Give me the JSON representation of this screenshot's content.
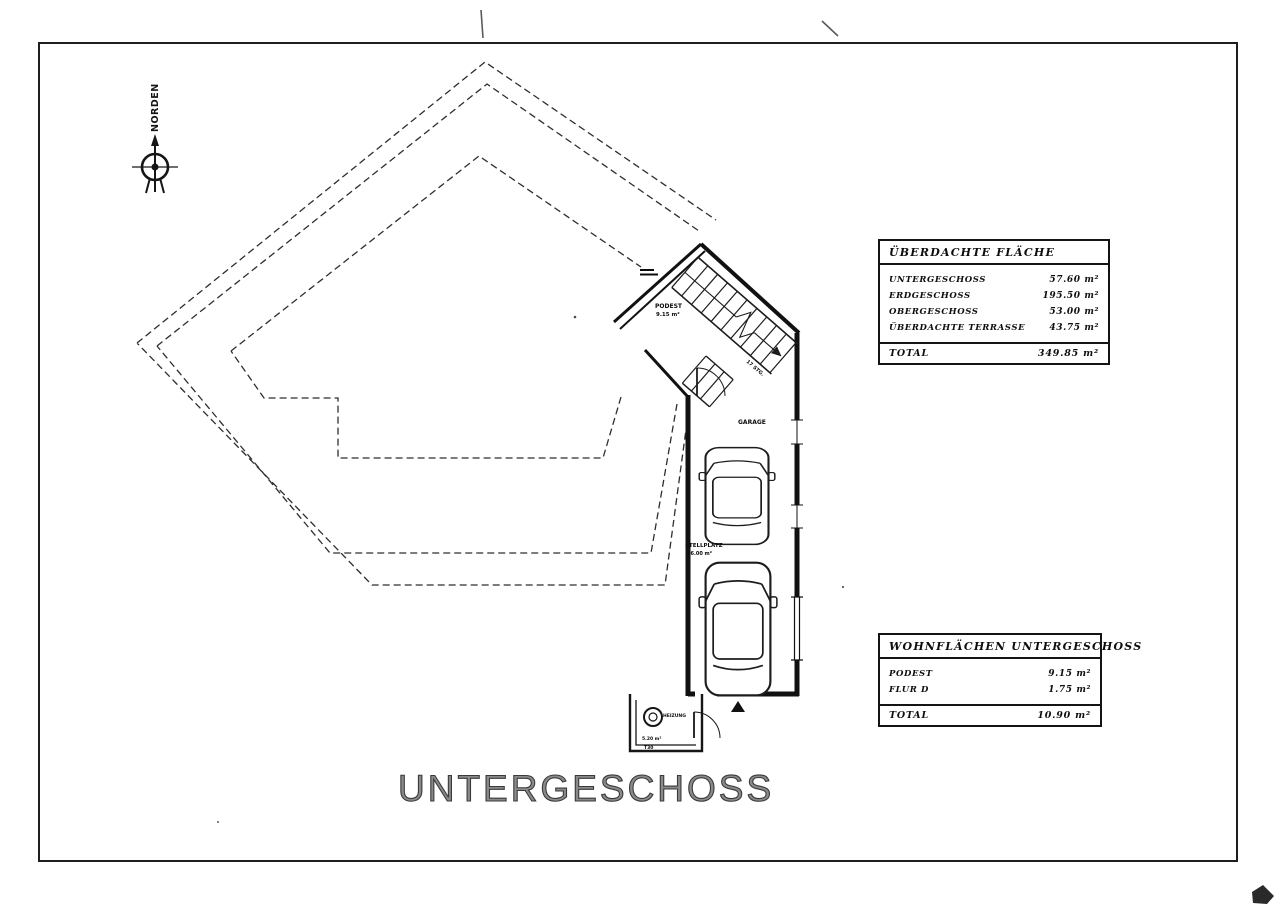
{
  "sheet": {
    "title": "UNTERGESCHOSS"
  },
  "compass": {
    "label": "NORDEN"
  },
  "tables": {
    "covered": {
      "header": "ÜBERDACHTE FLÄCHE",
      "rows": [
        {
          "label": "UNTERGESCHOSS",
          "value": "57.60 m²"
        },
        {
          "label": "ERDGESCHOSS",
          "value": "195.50 m²"
        },
        {
          "label": "OBERGESCHOSS",
          "value": "53.00 m²"
        },
        {
          "label": "ÜBERDACHTE TERRASSE",
          "value": "43.75 m²"
        }
      ],
      "total_label": "TOTAL",
      "total_value": "349.85 m²"
    },
    "living": {
      "header": "WOHNFLÄCHEN UNTERGESCHOSS",
      "rows": [
        {
          "label": "PODEST",
          "value": "9.15 m²"
        },
        {
          "label": "FLUR D",
          "value": "1.75 m²"
        }
      ],
      "total_label": "TOTAL",
      "total_value": "10.90 m²"
    }
  },
  "plan_labels": {
    "room1_name": "PODEST",
    "room1_area": "9.15 m²",
    "garage": "GARAGE",
    "stellplatz_name": "STELLPLATZ",
    "stellplatz_area": "36.00 m²",
    "stair_count": "17 STG.",
    "heizung": "HEIZUNG",
    "heizung_area": "5.20 m²",
    "door_class": "T30"
  }
}
